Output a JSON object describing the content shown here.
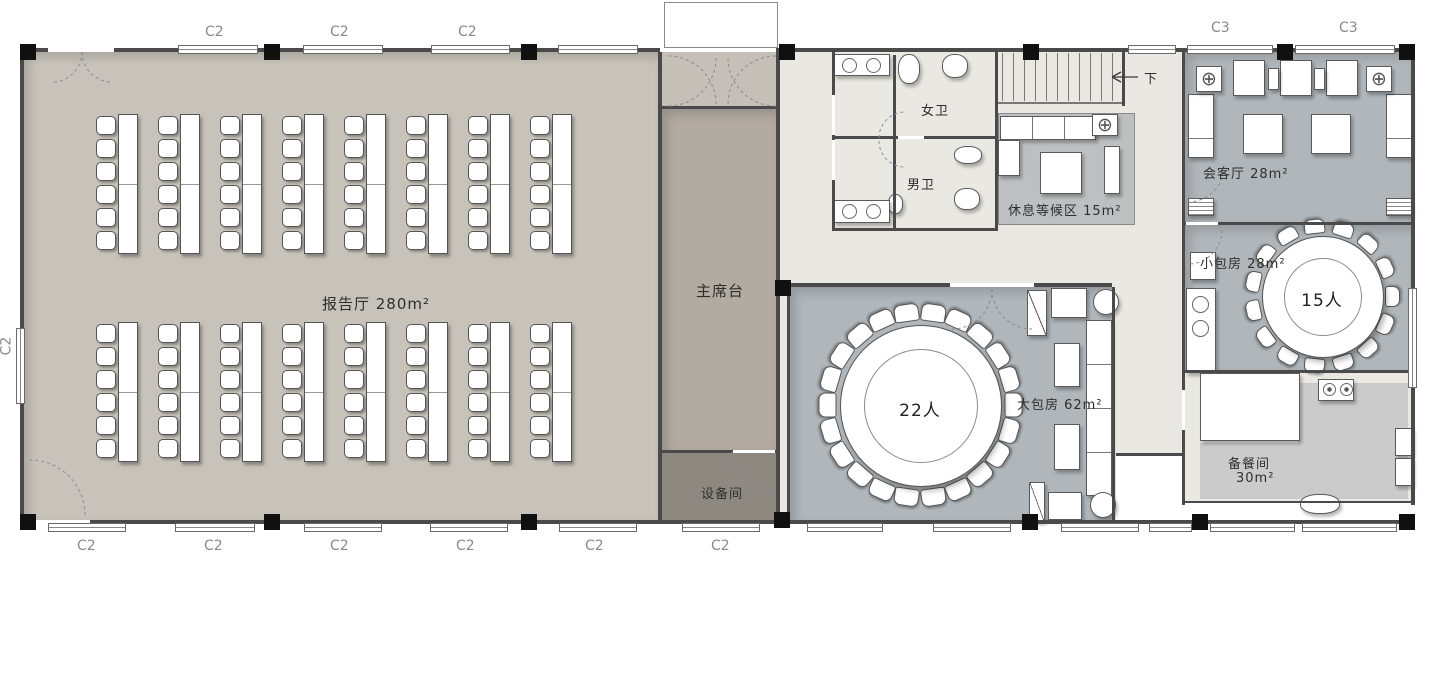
{
  "title": "二层领导包房及报告厅平面布置",
  "rooms": {
    "lecture_hall": {
      "label": "报告厅  280m²"
    },
    "stage": {
      "label": "主席台"
    },
    "equipment_room": {
      "label": "设备间"
    },
    "womens_wc": {
      "label": "女卫"
    },
    "mens_wc": {
      "label": "男卫"
    },
    "waiting_area": {
      "label": "休息等候区  15m²"
    },
    "reception_room": {
      "label": "会客厅  28m²"
    },
    "small_private_room": {
      "label": "小包房  28m²",
      "seats_label": "15人",
      "seat_count": 15
    },
    "large_private_room": {
      "label": "大包房  62m²",
      "seats_label": "22人",
      "seat_count": 22
    },
    "pantry": {
      "label_name": "备餐间",
      "label_area": "30m²"
    },
    "stairs": {
      "down_label": "下"
    }
  },
  "axis": {
    "top": [
      "C2",
      "C2",
      "C2",
      "C3",
      "C3"
    ],
    "bottom": [
      "C2",
      "C2",
      "C2",
      "C2",
      "C2",
      "C2"
    ],
    "left": [
      "C2"
    ]
  },
  "icons": {
    "planter": "⊕"
  },
  "colors": {
    "lecture_floor": "#c7c3ba",
    "stage_floor": "#b2aba1",
    "vestibule_floor": "#c5c0b7",
    "equipment_floor": "#8e8980",
    "corridor_floor": "#eae8e2",
    "room_floor_blue": "#b0b6ba",
    "waiting_floor": "#bdbfc1",
    "pantry_floor": "#cbcbcb",
    "wall": "#4a4a4a"
  },
  "lecture_seating": {
    "groups": 2,
    "columns": 8,
    "chairs_per_column": 6
  }
}
